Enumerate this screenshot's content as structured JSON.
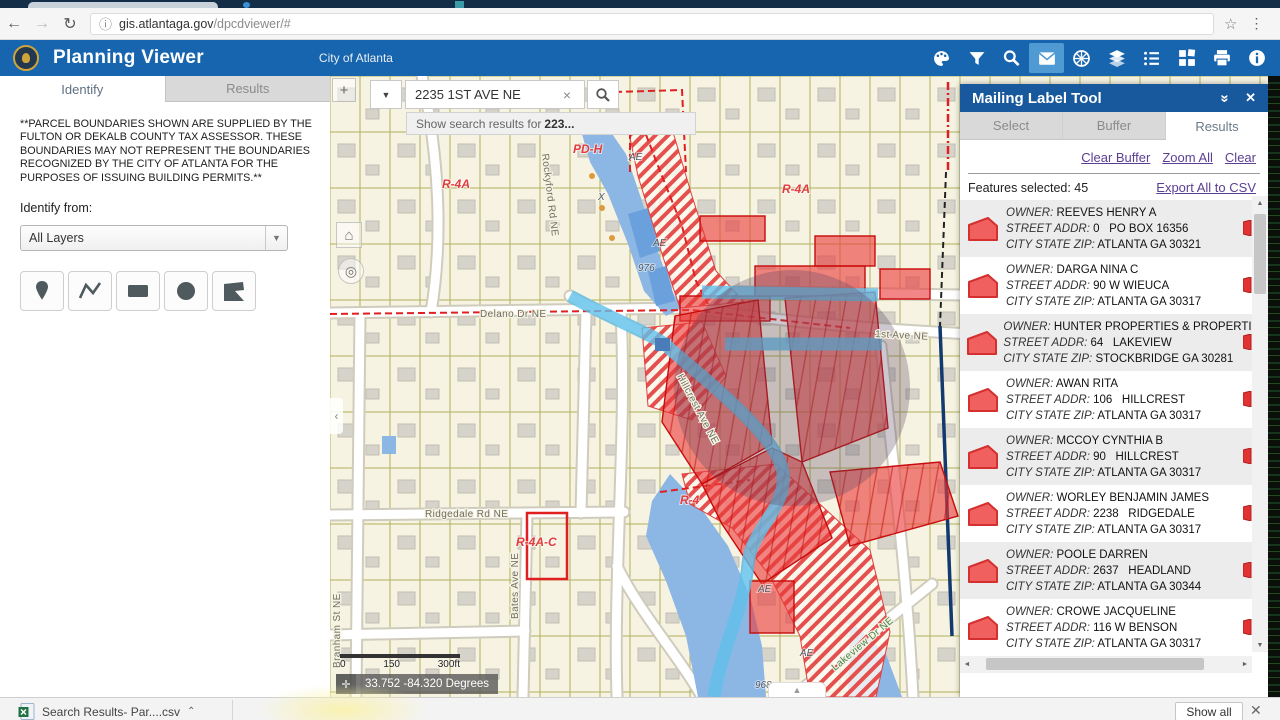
{
  "browser": {
    "url_domain": "gis.atlantaga.gov",
    "url_path": "/dpcdviewer/#",
    "back": "←",
    "forward": "→",
    "reload": "↻",
    "info": "ⓘ",
    "star": "☆",
    "menu": "⋮"
  },
  "header": {
    "title": "Planning Viewer",
    "subtitle": "City of Atlanta"
  },
  "left_panel": {
    "tabs": {
      "identify": "Identify",
      "results": "Results"
    },
    "disclaimer": "**PARCEL BOUNDARIES SHOWN ARE SUPPLIED BY THE FULTON OR DEKALB COUNTY TAX ASSESSOR. THESE BOUNDARIES MAY NOT REPRESENT THE BOUNDARIES RECOGNIZED BY THE CITY OF ATLANTA FOR THE PURPOSES OF ISSUING BUILDING PERMITS.**",
    "identify_from_label": "Identify from:",
    "layers_value": "All Layers"
  },
  "map": {
    "search": {
      "value": "2235 1ST AVE NE",
      "clear": "×",
      "dropdown": "▼",
      "suggestion_prefix": "Show search results for",
      "suggestion_term": "223..."
    },
    "labels": {
      "delano": "Delano Dr NE",
      "first_ave": "1st Ave NE",
      "ridgedale": "Ridgedale Rd NE",
      "bates": "Bates Ave NE",
      "hillcrest": "Hillcrest Ave NE",
      "rockyford": "Rockyford Rd NE",
      "lakeview": "Lakeview Dr NE",
      "branham": "Branham St NE",
      "r4a": "R-4A",
      "r4": "R-4",
      "r4ac": "R-4A-C",
      "pdh": "PD-H",
      "ae": "AE",
      "x": "X",
      "e976": "976",
      "e968": "968"
    },
    "scale": {
      "t0": "0",
      "t150": "150",
      "t300": "300ft"
    },
    "coordinates": "33.752 -84.320 Degrees",
    "zoom_in": "+",
    "home": "⌂",
    "locate": "◎",
    "collapse": "‹",
    "caret": "▲"
  },
  "right_panel": {
    "title": "Mailing Label Tool",
    "collapse": "»",
    "close": "✕",
    "tabs": {
      "0": "Select",
      "1": "Buffer",
      "2": "Results"
    },
    "links": {
      "clear_buffer": "Clear Buffer",
      "zoom_all": "Zoom All",
      "clear": "Clear"
    },
    "features_selected": "Features selected: 45",
    "export_link": "Export All to CSV",
    "fields": {
      "owner": "OWNER:",
      "street": "STREET ADDR:",
      "city": "CITY STATE ZIP:"
    },
    "results": [
      {
        "owner": "REEVES HENRY A",
        "street": "0   PO BOX 16356",
        "city": "ATLANTA GA 30321"
      },
      {
        "owner": "DARGA NINA C",
        "street": "90 W WIEUCA",
        "city": "ATLANTA GA 30317"
      },
      {
        "owner": "HUNTER PROPERTIES & PROPERTIES",
        "street": "64   LAKEVIEW",
        "city": "STOCKBRIDGE GA 30281"
      },
      {
        "owner": "AWAN RITA",
        "street": "106   HILLCREST",
        "city": "ATLANTA GA 30317"
      },
      {
        "owner": "MCCOY CYNTHIA B",
        "street": "90   HILLCREST",
        "city": "ATLANTA GA 30317"
      },
      {
        "owner": "WORLEY BENJAMIN JAMES",
        "street": "2238   RIDGEDALE",
        "city": "ATLANTA GA 30317"
      },
      {
        "owner": "POOLE DARREN",
        "street": "2637   HEADLAND",
        "city": "ATLANTA GA 30344"
      },
      {
        "owner": "CROWE JACQUELINE",
        "street": "116 W BENSON",
        "city": "ATLANTA GA 30317"
      }
    ]
  },
  "download_bar": {
    "filename": "Search Results- Par....csv",
    "caret": "⌃",
    "show_all": "Show all",
    "close": "✕"
  }
}
